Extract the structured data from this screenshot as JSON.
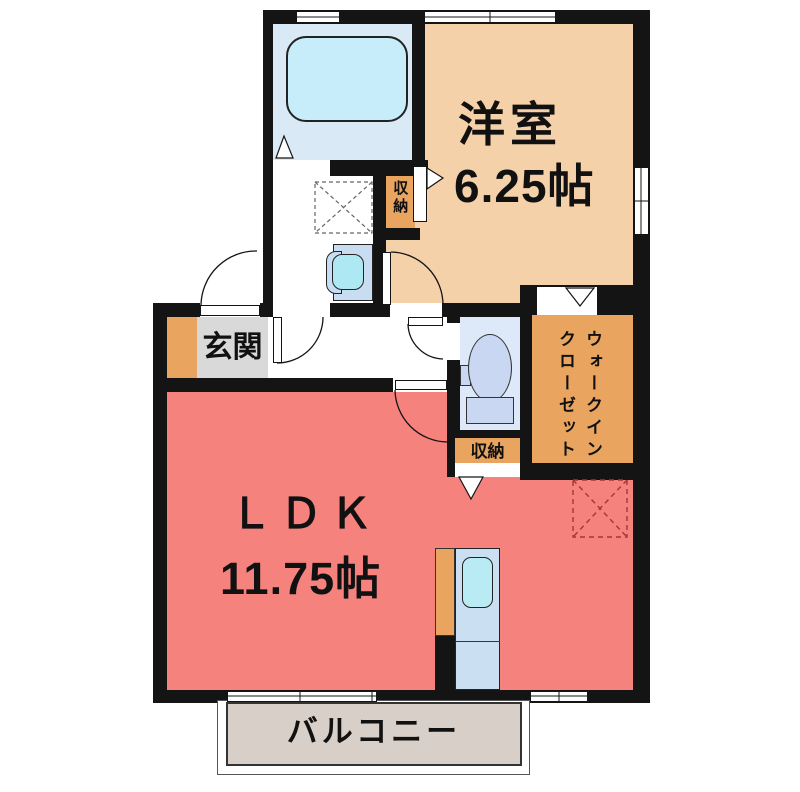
{
  "plan_title": "1LDK apartment floor plan",
  "rooms": {
    "yoshitsu": {
      "name": "洋室",
      "size": "6.25帖"
    },
    "ldk": {
      "name": "ＬＤＫ",
      "size": "11.75帖"
    },
    "genkan": {
      "name": "玄関"
    },
    "wic": {
      "name": "ウォークイン\nクローゼット"
    },
    "storage_mid": {
      "name": "収納"
    },
    "storage_ldk": {
      "name": "収納"
    },
    "balcony": {
      "name": "バルコニー"
    }
  },
  "colors": {
    "wall": "#141414",
    "yoshitsu_floor": "#F5D1A9",
    "ldk_floor": "#F5827D",
    "closet_orange": "#E9A45F",
    "genkan_gray": "#D9D9D9",
    "bath_floor": "#D9E9F6",
    "bathtub": "#C7EDFA",
    "fixture_blue": "#CBDFF2",
    "sink_cyan": "#B9EBF4",
    "toilet_floor": "#DDE9F8",
    "toilet_fixture": "#C9D7F2",
    "balcony_floor": "#D8D0C8",
    "ldk_dash_square": "#A03838",
    "washer_dash_square": "#666666"
  }
}
